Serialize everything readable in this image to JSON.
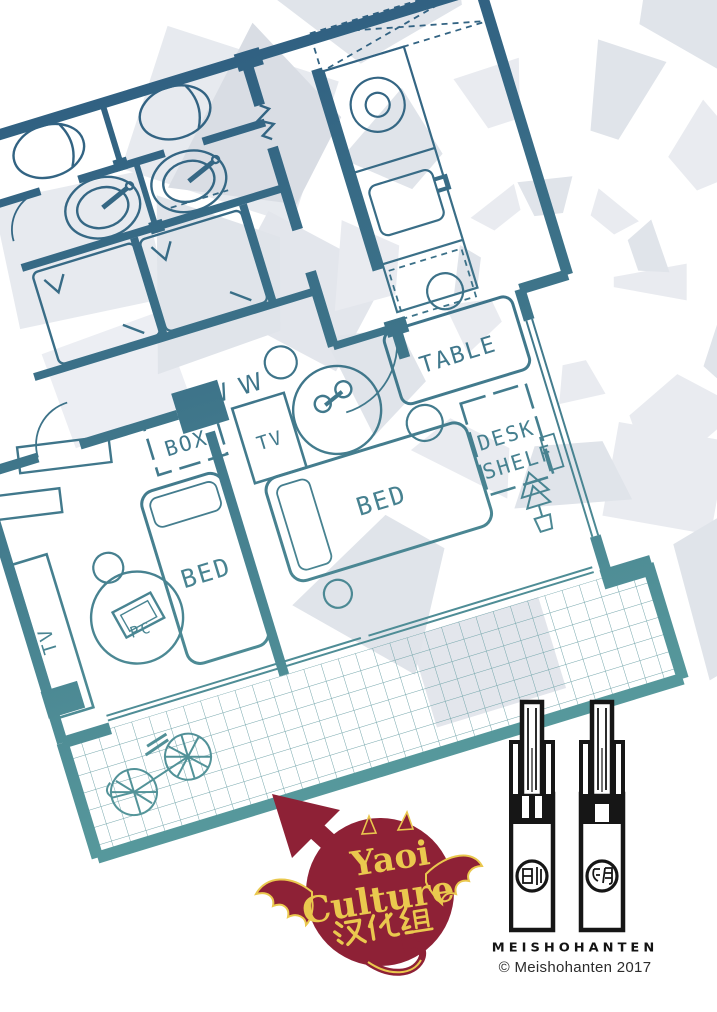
{
  "plan": {
    "labels": {
      "table": "TABLE",
      "box": "BOX",
      "tv_center": "TV",
      "bed_center": "BED",
      "bed_left": "BED",
      "desk": "DESK",
      "shelf": "SHELF",
      "pc": "PC",
      "tv_left": "TV",
      "washer_marks": "W W"
    }
  },
  "logo": {
    "title_line1": "Yaoi",
    "title_line2": "Culture",
    "title_line3": "汉化组"
  },
  "publisher": {
    "brand": "MEISHOHANTEN",
    "copyright": "© Meishohanten 2017",
    "seal_left_glyph": "創",
    "seal_right_glyph": "朗"
  },
  "colors": {
    "plan_top": "#2e5d80",
    "plan_bottom": "#57999c",
    "logo_red": "#8e2136",
    "logo_yellow": "#eac84e",
    "burst_gray_light": "#e9ebf0",
    "burst_gray_dark": "#d9dde4",
    "ink": "#161616"
  }
}
